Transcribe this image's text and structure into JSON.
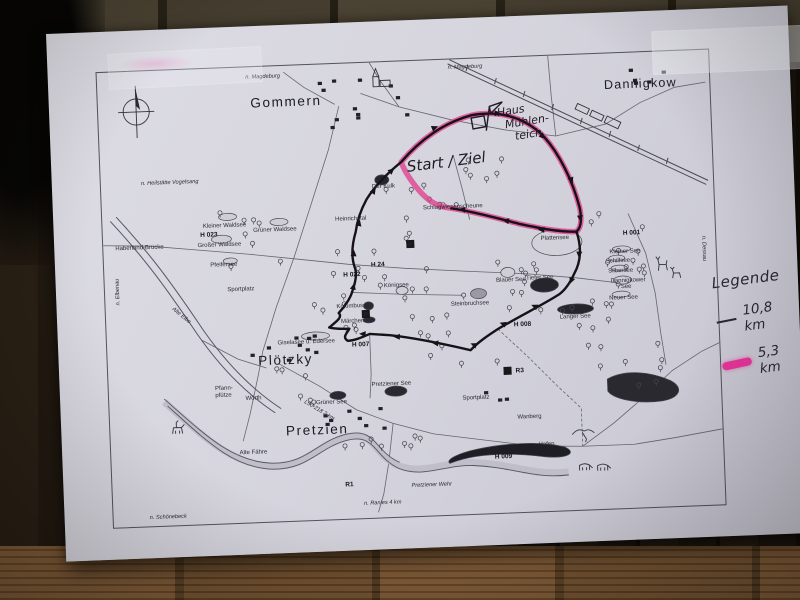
{
  "legend": {
    "title": "Legende",
    "items": [
      {
        "label": "10,8 km",
        "color": "#2a2a30",
        "style": "thin-black-line"
      },
      {
        "label": "5,3 km",
        "color": "#e8359b",
        "style": "pink-highlight"
      }
    ]
  },
  "map": {
    "towns": {
      "gommern": "Gommern",
      "dannigkow": "Dannigkow",
      "ploetzky": "Plötzky",
      "pretzien": "Pretzien"
    },
    "handwritten": {
      "start_ziel": "Start / Ziel",
      "haus_line1": "Haus",
      "haus_line2": "Mühlen-",
      "haus_line3": "teich"
    },
    "directions": {
      "magdeburg1": "n. Magdeburg",
      "magdeburg2": "n. Magdeburg",
      "heilstaette": "n. Heilstätte Vogelsang",
      "elbenau": "n. Elbenau",
      "schoenebeck": "n. Schönebeck",
      "ranies": "n. Ranies 4 km",
      "dessau": "n. Dessau"
    },
    "waters": {
      "kleiner_waldsee": "Kleiner Waldsee",
      "grosser_waldsee": "Großer Waldsee",
      "gruener_waldsee": "Grüner Waldsee",
      "pfeifersee": "Pfeifersee",
      "koenigsee": "Königsee",
      "kolumbussee": "Kolumbussee",
      "maerchensee": "Märchensee",
      "giselasee": "Giselasee u. Edersee",
      "plattensee": "Plattensee",
      "kleiner_see": "Kleiner See",
      "schilfsee": "Schilfsee",
      "silbersee": "Silbersee",
      "dannigkower_see_1": "Dannigkower",
      "dannigkower_see_2": "See",
      "neuer_see": "Neuer See",
      "blauer_see": "Blauer See",
      "steinbruchsee": "Steinbruchsee",
      "tiefer_see": "Tiefer See",
      "langer_see": "Langer See",
      "gruener_see": "Grüner See",
      "pretziener_see": "Pretziener See",
      "alte_elbe": "Alte Elbe",
      "der_kulk": "Der Kulk"
    },
    "places": {
      "haberland": "Haberland-Brücke",
      "sportplatz1": "Sportplatz",
      "sportplatz2": "Sportplatz",
      "heinrichstal": "Heinrichstal",
      "scheune": "Schlagwiesenscheune",
      "pfann1": "Pfann-",
      "pfann2": "pfütze",
      "woerth": "Wörth",
      "wanberg": "Wanberg",
      "hafen": "Hafen",
      "wehr": "Pretziener Wehr",
      "alte_faehre": "Alte Fähre",
      "l50": "L50-218  2 km"
    },
    "markers": {
      "h023": "H 023",
      "h022": "H 022",
      "h024": "H 24",
      "h007": "H 007",
      "h001": "H 001",
      "h008": "H 008",
      "h009": "H 009",
      "r1": "R1",
      "r3": "R3",
      "p": "P"
    }
  }
}
